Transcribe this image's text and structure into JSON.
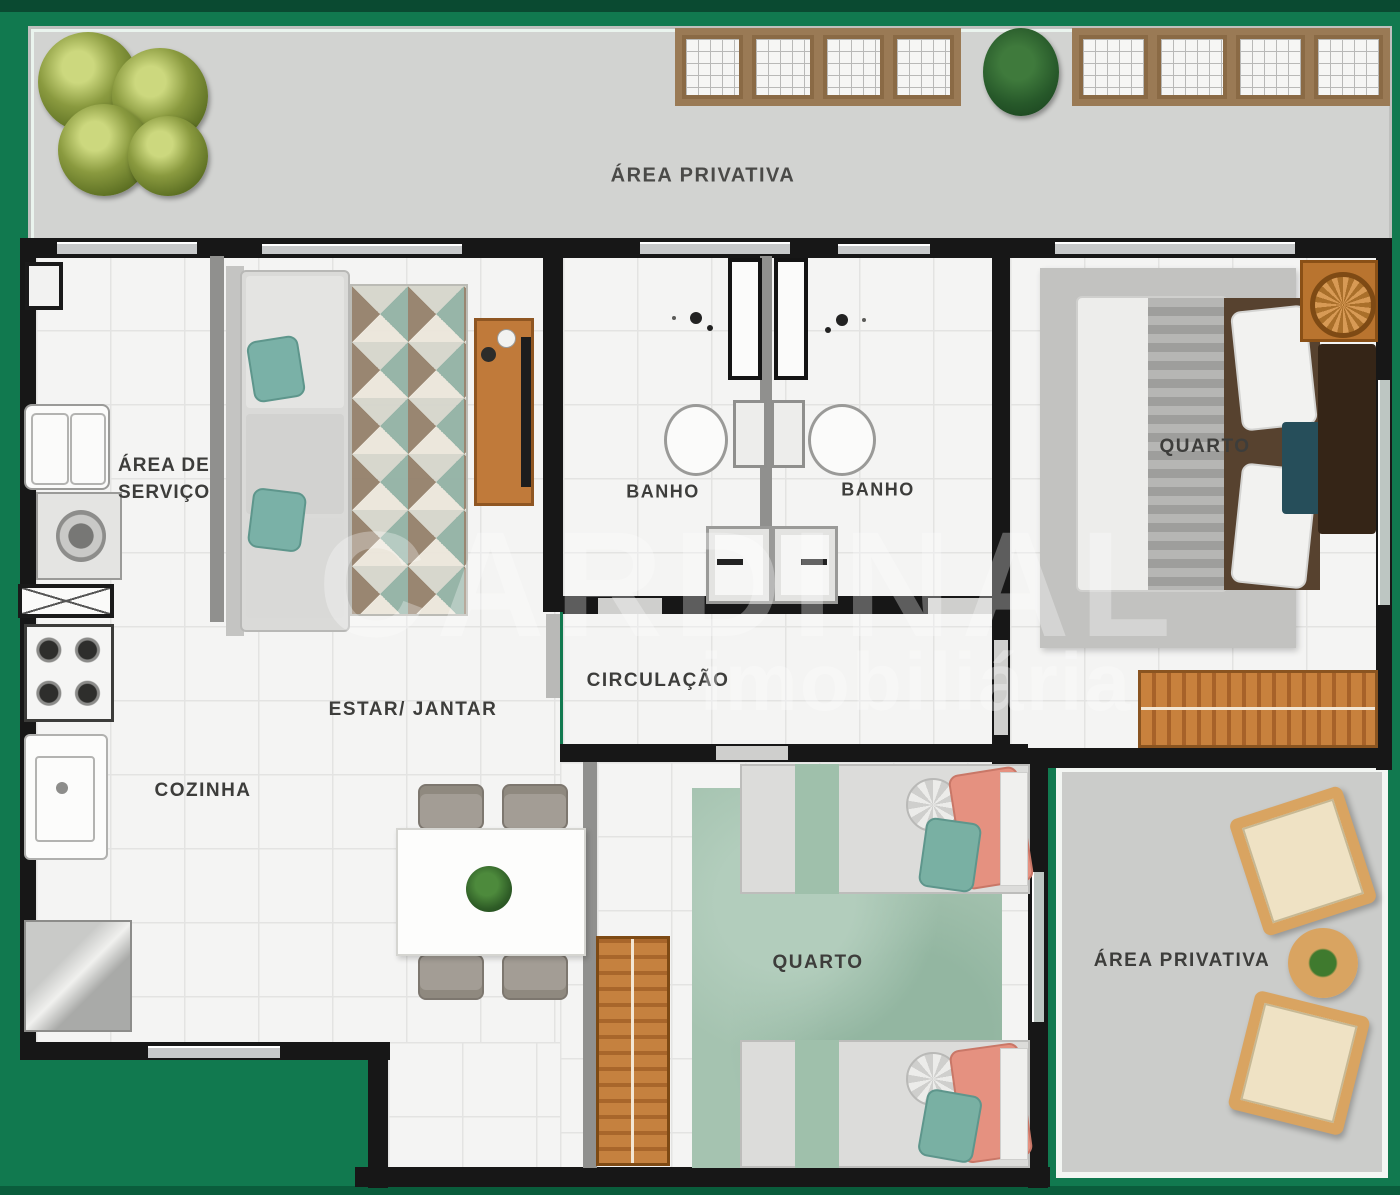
{
  "meta": {
    "type": "residential-floor-plan",
    "style": "top-view humanized plan"
  },
  "palette": {
    "background_green": "#11794f",
    "background_green_dark": "#0a4b32",
    "wall_black": "#171717",
    "wall_gray": "#90908e",
    "terrace_floor": "#d2d3d1",
    "interior_floor": "#f4f4f3",
    "wood_orange": "#bd7a3a",
    "teal_accent": "#79b2a8",
    "bedroom_rug_green": "#a5c3b0",
    "suite_rug_gray": "#c2c2c0",
    "label_text": "#3d3d3b",
    "watermark_white": "rgba(255,255,255,0.30)"
  },
  "rooms": {
    "terrace_top": {
      "label": "ÁREA PRIVATIVA"
    },
    "service_area": {
      "label_line1": "ÁREA DE",
      "label_line2": "SERVIÇO"
    },
    "bathroom_left": {
      "label": "BANHO"
    },
    "bathroom_right": {
      "label": "BANHO"
    },
    "bedroom_suite": {
      "label": "QUARTO"
    },
    "circulation": {
      "label": "CIRCULAÇÃO"
    },
    "living_dining": {
      "label": "ESTAR/ JANTAR"
    },
    "kitchen": {
      "label": "COZINHA"
    },
    "bedroom_twin": {
      "label": "QUARTO"
    },
    "terrace_bottom": {
      "label": "ÁREA PRIVATIVA"
    }
  },
  "watermark": {
    "line1": "CARDINAL",
    "line2": "imobiliária"
  }
}
